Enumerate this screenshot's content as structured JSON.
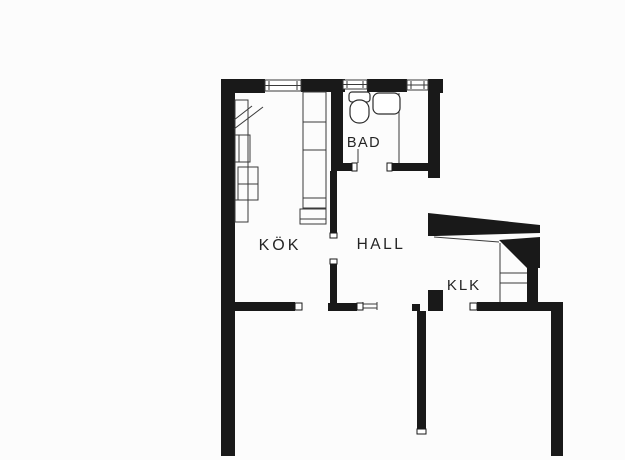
{
  "document": {
    "type": "floor-plan",
    "background": "#fcfcfc",
    "wall_color": "#191919",
    "thin_line_color": "#3a3a3a",
    "label_color": "#242424"
  },
  "rooms": [
    {
      "id": "kok",
      "label": "KÖK"
    },
    {
      "id": "bad",
      "label": "BAD"
    },
    {
      "id": "hall",
      "label": "HALL"
    },
    {
      "id": "klk",
      "label": "KLK"
    }
  ],
  "plan": {
    "canvas": {
      "w": 625,
      "h": 460
    },
    "walls": [
      [
        221,
        79,
        44,
        14
      ],
      [
        301,
        79,
        44,
        13
      ],
      [
        367,
        79,
        40,
        13
      ],
      [
        428,
        79,
        15,
        14
      ],
      [
        221,
        79,
        14,
        377
      ],
      [
        428,
        92,
        12,
        86
      ],
      [
        331,
        92,
        12,
        79
      ],
      [
        343,
        163,
        9,
        8
      ],
      [
        392,
        163,
        36,
        8
      ],
      [
        330,
        171,
        7,
        62
      ],
      [
        330,
        264,
        7,
        39
      ],
      [
        328,
        303,
        29,
        8
      ],
      [
        221,
        302,
        74,
        9
      ],
      [
        428,
        290,
        15,
        21
      ],
      [
        412,
        304,
        8,
        7
      ],
      [
        417,
        311,
        9,
        119
      ],
      [
        477,
        302,
        86,
        9
      ],
      [
        551,
        302,
        12,
        154
      ],
      [
        527,
        266,
        11,
        36
      ]
    ],
    "polygons": [
      [
        [
          428,
          213
        ],
        [
          540,
          225
        ],
        [
          540,
          233
        ],
        [
          436,
          236
        ],
        [
          428,
          236
        ]
      ],
      [
        [
          499,
          240
        ],
        [
          540,
          237
        ],
        [
          540,
          268
        ],
        [
          527,
          268
        ]
      ]
    ],
    "windows": [
      {
        "x": 265,
        "y": 80,
        "w": 36,
        "h": 11
      },
      {
        "x": 343,
        "y": 80,
        "w": 24,
        "h": 9
      },
      {
        "x": 407,
        "y": 80,
        "w": 21,
        "h": 10
      }
    ],
    "jambs": [
      [
        295,
        303,
        7,
        7
      ],
      [
        352,
        163,
        5,
        8
      ],
      [
        387,
        163,
        5,
        8
      ],
      [
        330,
        233,
        7,
        5
      ],
      [
        330,
        259,
        7,
        5
      ],
      [
        357,
        303,
        6,
        7
      ],
      [
        470,
        303,
        7,
        7
      ],
      [
        417,
        429,
        9,
        5
      ]
    ],
    "thin_lines": [
      [
        399,
        93,
        399,
        163
      ],
      [
        358,
        149,
        358,
        163
      ],
      [
        363,
        304,
        377,
        304
      ],
      [
        363,
        308,
        377,
        308
      ],
      [
        363,
        302,
        363,
        310
      ],
      [
        377,
        302,
        377,
        310
      ],
      [
        500,
        243,
        500,
        302
      ],
      [
        500,
        273,
        527,
        273
      ],
      [
        500,
        283,
        527,
        283
      ],
      [
        434,
        237,
        499,
        242
      ]
    ],
    "counters": {
      "rects": [
        [
          235,
          100,
          13,
          122
        ],
        [
          239,
          135,
          11,
          27
        ],
        [
          238,
          167,
          20,
          17
        ],
        [
          238,
          184,
          20,
          16
        ],
        [
          303,
          92,
          23,
          116
        ],
        [
          300,
          209,
          26,
          15
        ]
      ],
      "divider_lines": [
        [
          235,
          135,
          248,
          135
        ],
        [
          235,
          162,
          248,
          162
        ],
        [
          235,
          200,
          248,
          200
        ],
        [
          303,
          122,
          326,
          122
        ],
        [
          303,
          150,
          326,
          150
        ],
        [
          303,
          198,
          326,
          198
        ],
        [
          300,
          219,
          326,
          219
        ]
      ],
      "diagonals": [
        [
          234,
          129,
          263,
          107
        ],
        [
          234,
          120,
          252,
          106
        ]
      ]
    },
    "fixtures": {
      "toilet": {
        "tank": [
          349,
          92,
          21,
          10
        ],
        "bowl": [
          350,
          100,
          19,
          23
        ]
      },
      "sink": {
        "body": [
          373,
          93,
          27,
          21
        ]
      }
    },
    "labels": [
      {
        "room": 0,
        "x": 280,
        "y": 250,
        "size": 16,
        "spacing": 3
      },
      {
        "room": 1,
        "x": 364,
        "y": 147,
        "size": 14.5,
        "spacing": 1.5
      },
      {
        "room": 2,
        "x": 381,
        "y": 249,
        "size": 15.5,
        "spacing": 2.5
      },
      {
        "room": 3,
        "x": 464,
        "y": 290,
        "size": 15,
        "spacing": 2
      }
    ]
  }
}
